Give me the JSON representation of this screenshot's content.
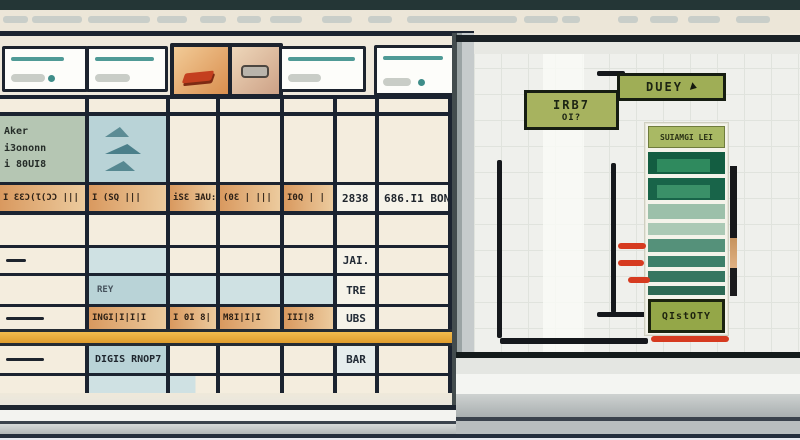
{
  "chrome": {
    "top_bar_color": "#243636",
    "menu_dashes": [
      [
        3,
        25
      ],
      [
        32,
        50
      ],
      [
        88,
        62
      ],
      [
        157,
        30
      ],
      [
        200,
        26
      ],
      [
        237,
        24
      ],
      [
        270,
        32
      ],
      [
        322,
        30
      ],
      [
        368,
        24
      ],
      [
        407,
        110
      ],
      [
        524,
        34
      ],
      [
        562,
        18
      ],
      [
        618,
        20
      ],
      [
        650,
        28
      ],
      [
        688,
        32
      ],
      [
        736,
        34
      ]
    ]
  },
  "toolbar": {
    "accent_color": "#4f9a96",
    "icons": [
      "text-lines",
      "text-lines",
      "eraser-icon",
      "battery-icon",
      "text-lines",
      "text-lines"
    ]
  },
  "sheet": {
    "info_cell_lines": [
      "Aker",
      "i3ononn",
      "i 80UI8"
    ],
    "barcode_row": [
      "I ƐƐƆ(Ɩ(ƆƆ |||",
      "I (SQ |||",
      "iSƐ ƎAU:",
      "(0Ɛ | |||",
      "I0Q | |"
    ],
    "value_row": [
      "2838",
      "686.I1  BONI"
    ],
    "labels": {
      "jai": "JAI.",
      "rey": "REY",
      "tre": "TRE",
      "ubs": "UBS",
      "bar": "BAR"
    },
    "orange_cells_2": [
      "INGI|I|I|I",
      "I 0I 8|",
      "M8I|I|I",
      "III|8"
    ],
    "note_cell": "DIGIS RNOP7",
    "highlight_bar_color": "#eaa83c",
    "grid_line_color": "#1b2330"
  },
  "panel": {
    "buttons": {
      "duey": "DUEY",
      "irb7_line1": "IRB7",
      "irb7_line2": "OI?",
      "custom": "QIstOTY"
    },
    "list": {
      "header": "SUIAMGI LEI",
      "bars": [
        {
          "h": 22,
          "c": "#135d41",
          "inner": "#2f8a5e"
        },
        {
          "h": 22,
          "c": "#186449",
          "inner": "#3a9068"
        },
        {
          "h": 15,
          "c": "#9cc0aa"
        },
        {
          "h": 12,
          "c": "#abc9b5"
        },
        {
          "h": 13,
          "c": "#55917a"
        },
        {
          "h": 11,
          "c": "#3d8069"
        },
        {
          "h": 11,
          "c": "#367660"
        },
        {
          "h": 9,
          "c": "#2e6a54"
        }
      ]
    },
    "red_marks": [
      {
        "x": 144,
        "y": 201,
        "w": 28
      },
      {
        "x": 144,
        "y": 218,
        "w": 26
      },
      {
        "x": 154,
        "y": 235,
        "w": 22
      },
      {
        "x": 177,
        "y": 294,
        "w": 78
      }
    ],
    "colors": {
      "button_green": "#9fae56",
      "annotation_red": "#d63b20",
      "grid_bg": "#eff0ec"
    }
  }
}
